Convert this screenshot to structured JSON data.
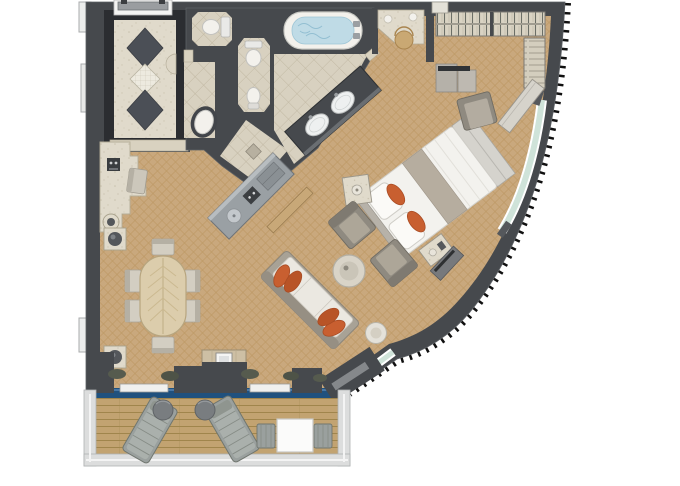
{
  "scene": {
    "kind": "floor-plan-rendering",
    "view": "top-down",
    "footprint": "fan-shaped suite with curved outer hull wall and rectangular balcony"
  },
  "colors": {
    "wall": "#46494d",
    "corridor_border": "#2b2d31",
    "marble": "#e0dacb",
    "tile": "#d8d1c0",
    "tile_line": "#c0b7a1",
    "carpet": "#c9a87d",
    "carpet_line": "#b2894d",
    "deck": "#c2a371",
    "deck_line": "#a0854c",
    "glass_blue": "#20517e",
    "window_teal": "#cfe3d9",
    "cream": "#f3f1ec",
    "orange": "#c85f30",
    "orange_dark": "#a94c24",
    "sofa_frame": "#a8a296",
    "cushion": "#ebe8e1",
    "chair_gray": "#8f8a80",
    "lounger_gray": "#9aa09e",
    "wood": "#dccdac",
    "rail": "#dcdddd",
    "fixture_white": "#f6f6f4",
    "counter_dark": "#3f4246",
    "plant": "#565b4e"
  },
  "rooms": [
    {
      "id": "entry-hall",
      "features": [
        "double-entry-door",
        "diamond-marble-floor"
      ]
    },
    {
      "id": "guest-wc",
      "features": [
        "toilet"
      ]
    },
    {
      "id": "master-wc",
      "features": [
        "toilet",
        "bidet"
      ]
    },
    {
      "id": "washroom",
      "features": [
        "oval-basin"
      ]
    },
    {
      "id": "bathroom",
      "features": [
        "whirlpool-bathtub",
        "double-sink-vanity",
        "shower-with-drain"
      ]
    },
    {
      "id": "walk-in-closet",
      "features": [
        "hanging-rails",
        "shelf-column",
        "dressers"
      ]
    },
    {
      "id": "bedroom",
      "features": [
        "diagonal-king-bed",
        "orange-accent-pillows",
        "foot-bench",
        "nightstands",
        "vanity-with-stool",
        "armchair",
        "curved-wall-desk",
        "media-console"
      ]
    },
    {
      "id": "living-dining",
      "features": [
        "sofa-with-orange-pillows",
        "two-armchairs",
        "round-coffee-table",
        "round-side-table",
        "oval-dining-table-6-chairs",
        "wet-bar",
        "marble-bar-counter",
        "espresso-machine",
        "tv-console",
        "planters"
      ]
    },
    {
      "id": "balcony",
      "features": [
        "two-sun-loungers",
        "two-round-side-tables",
        "square-table-2-chairs",
        "railing",
        "sliding-glass-doors"
      ]
    }
  ]
}
